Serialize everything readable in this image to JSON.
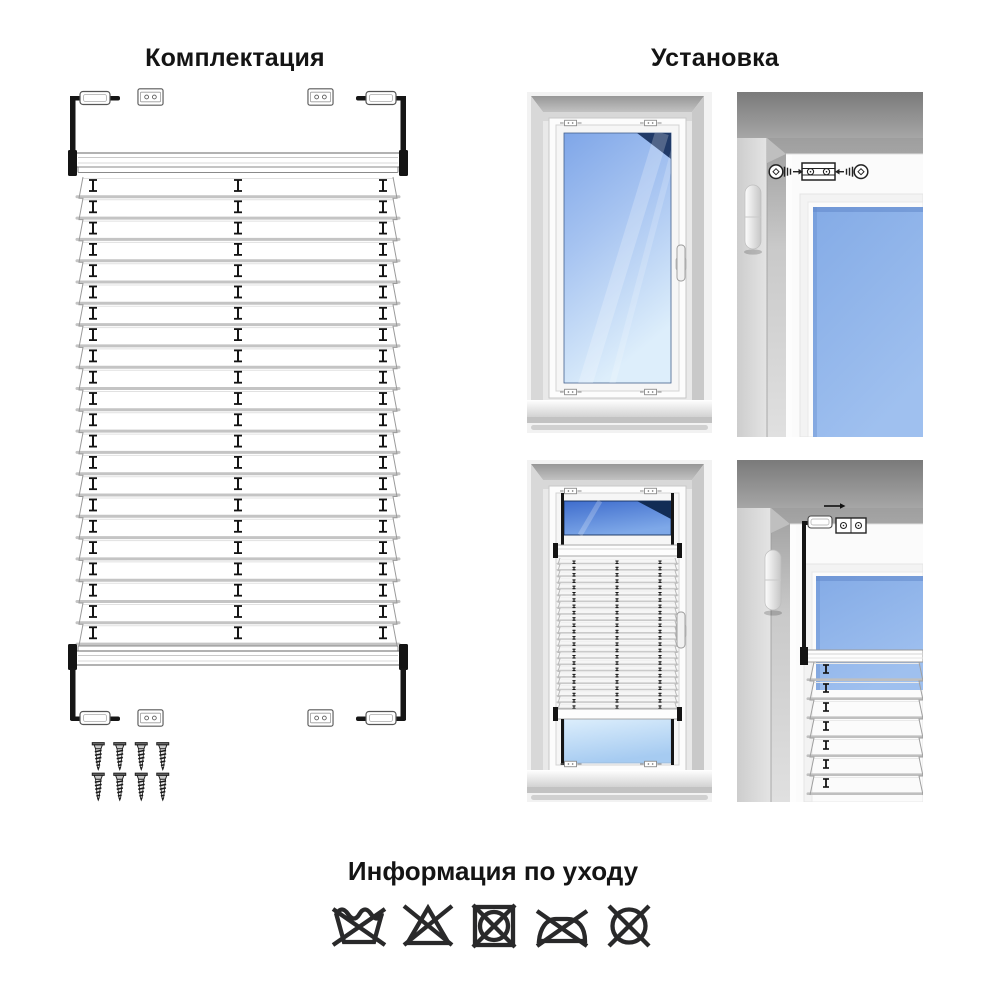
{
  "titles": {
    "equipment": "Комплектация",
    "installation": "Установка",
    "care": "Информация по уходу"
  },
  "equipment_drawing": {
    "pleat_count": 22,
    "cord_marker_columns": 3,
    "tension_brackets": 4,
    "mounting_clips": 4,
    "screw_rows": 2,
    "screws_per_row": 4,
    "screws_total": 8
  },
  "installation": {
    "panels": [
      "window-without-blind",
      "clip-screw-mounting-detail",
      "window-with-pleated-blind",
      "bracket-hook-on-clip-detail"
    ],
    "blind_pleats_visible": 24,
    "detail_pleats_visible": 7
  },
  "care_symbols": [
    "do-not-wash",
    "do-not-bleach",
    "do-not-tumble-dry",
    "do-not-iron",
    "do-not-dry-clean"
  ],
  "colors": {
    "background": "#ffffff",
    "line_art": "#1a1a1a",
    "pleat_fold": "#c4c4c4",
    "glass_blue": "#7fa6e8",
    "glass_dark_corner": "#203a68",
    "glass_light": "#dcecfb",
    "wall_gray": "#bdbdbd"
  }
}
